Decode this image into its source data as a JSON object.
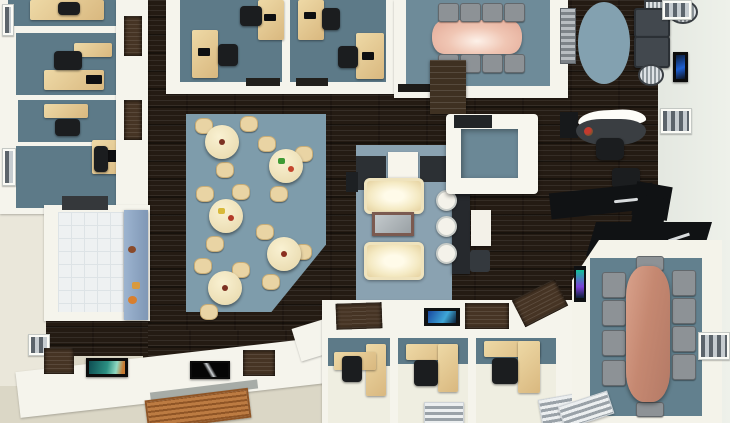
{
  "scene": {
    "kind": "photorealistic 3D architectural render",
    "subject": "office floor plan viewed from directly above",
    "visible_text": "none"
  },
  "palette": {
    "wood_floor": "#241b13",
    "wall": "#f5f4ec",
    "office_floor": "#5d7a88",
    "office_floor_light": "#6e8b99",
    "cafe_rug": "#7e9cab",
    "lounge_rug": "#8aa2b1",
    "oval_rug": "#83a1b0",
    "conference_floor": "#62808e",
    "desk_wood": "#dfbf8b",
    "round_table": "#f0e6c2",
    "conference_table_north": "#e2a794",
    "conference_table_east": "#c58871",
    "sofa_cream": "#f7f0d6",
    "counter_black": "#101214",
    "chair_gray": "#8d9296",
    "chair_black": "#1b1d1f",
    "kitchen_tile": "#eef1f2",
    "kitchen_counter_blue": "#8fa8c4",
    "doormat": "#b5743d",
    "exterior_ground": "#dbd7c6",
    "exterior_wall_right": "#e9ece5"
  },
  "rooms": [
    {
      "id": "private-offices-west",
      "label": "Private offices west",
      "desks": 5,
      "office_chairs": 5,
      "floor": "slate blue"
    },
    {
      "id": "offices-north",
      "label": "Offices north",
      "desks": 4,
      "office_chairs": 4,
      "floor": "slate blue"
    },
    {
      "id": "conference-north",
      "label": "Conference room north",
      "table": "rose boat-shaped",
      "chairs": 8,
      "floor": "slate blue"
    },
    {
      "id": "waiting-area",
      "label": "Waiting area",
      "armchairs": 2,
      "side_tables": 3,
      "rug": "blue oval"
    },
    {
      "id": "reception",
      "label": "Reception",
      "desk": "curved white-top",
      "office_chairs": 1
    },
    {
      "id": "bar-counter",
      "label": "Black angled counter",
      "office_chairs": 2
    },
    {
      "id": "cafeteria",
      "label": "Cafeteria",
      "round_tables": 5,
      "chairs_per_table": 3,
      "rug": "blue polygon"
    },
    {
      "id": "lounge",
      "label": "Lounge",
      "sofas": 2,
      "coffee_table": 1,
      "media_cabinets": 2
    },
    {
      "id": "meeting-pod",
      "label": "Meeting pod cube",
      "floor": "slate blue"
    },
    {
      "id": "standing-table",
      "label": "High table",
      "stools_white": 3,
      "stools_dark": 1
    },
    {
      "id": "kitchen",
      "label": "Kitchen",
      "floor": "white tile",
      "counter": "blue with snacks"
    },
    {
      "id": "conference-east",
      "label": "Conference room east",
      "table": "copper boat-shaped",
      "chairs": 10,
      "tv": 1
    },
    {
      "id": "offices-south",
      "label": "Offices south",
      "desks": 3,
      "office_chairs": 3
    },
    {
      "id": "entrance",
      "label": "Entrance",
      "doormat": "brown striped"
    }
  ],
  "decor": {
    "wall_art_pieces": 4,
    "wall_benches": 2,
    "shelf_niches": 2,
    "wood_cabinet": 1,
    "windows": 8,
    "wall_tablet_screens": 2
  }
}
